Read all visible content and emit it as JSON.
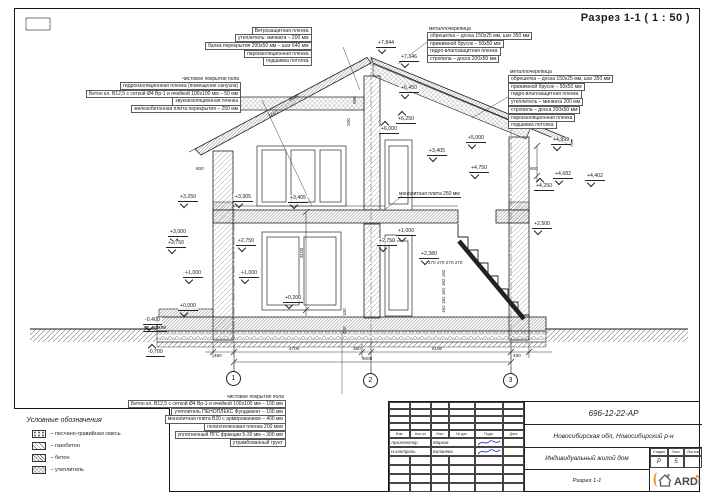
{
  "title": "Разрез 1-1 ( 1 : 50 )",
  "colors": {
    "accent": "#F7941E",
    "line": "#1c1c1c",
    "signature_blue": "#2a3ec9"
  },
  "annotation_blocks": [
    {
      "id": "ceiling-left",
      "x": 205,
      "y": 27,
      "align": "right",
      "title": "",
      "rows": [
        "Ветрозащитная пленка",
        "утеплитель: минвата – 200 мм",
        "балка перекрытия 200х50 мм – шаг 640 мм",
        "пароизоляционная пленка",
        "подшивка потолка"
      ]
    },
    {
      "id": "floor-2nd",
      "x": 86,
      "y": 76,
      "align": "right",
      "title": "чистовое покрытие пола",
      "rows": [
        "гидроизоляционная пленка (помещение санузла)",
        "Бетон кл. В12,5 с сеткой Ø4 Вр-1 и ячейкой 100х100 мм – 50 мм",
        "звукоизоляционная пленка",
        "железобетонная плита перекрытия – 250 мм"
      ]
    },
    {
      "id": "roof-cold",
      "x": 427,
      "y": 26,
      "align": "left",
      "title": "металлочерепица",
      "rows": [
        "обрешетка – доска 150х25 мм, шаг 350 мм",
        "прижимной брусок – 50х50 мм",
        "гидро-влагозащитная пленка",
        "стропила – доска 200х50 мм"
      ]
    },
    {
      "id": "roof-warm",
      "x": 508,
      "y": 69,
      "align": "left",
      "title": "металлочерепица",
      "rows": [
        "обрешетка – доска 150х25 мм, шаг 350 мм",
        "прижимной брусок – 50х50 мм",
        "гидро-влагозащитная пленка",
        "утеплитель – минвата 200 мм",
        "стропила – доска 200х50 мм",
        "пароизоляционная пленка",
        "подшивка потолка"
      ]
    },
    {
      "id": "floor-ground",
      "x": 128,
      "y": 394,
      "align": "right",
      "title": "чистовое покрытие пола",
      "rows": [
        "Бетон кл. В12,5 с сеткой Ø4 Вр-1 и ячейкой 100х100 мм – 100 мм",
        "утеплитель ПЕНОПЛЕКС Фундамент – 100 мм",
        "монолитная плита В20 с армированием – 400 мм",
        "полиэтиленовая пленка 200 мкм",
        "уплотненный ПГС фракции 5-20 мм – 300 мм",
        "утрамбованный грунт"
      ]
    }
  ],
  "labels": [
    {
      "t": "монолитная плита 250 мм",
      "x": 398,
      "y": 191,
      "u": true
    },
    {
      "t": "ур. земли",
      "x": 143,
      "y": 325,
      "u": true
    }
  ],
  "elevations": [
    {
      "v": "+7,844",
      "x": 376,
      "y": 40,
      "d": "down"
    },
    {
      "v": "+7,346",
      "x": 399,
      "y": 54,
      "d": "down"
    },
    {
      "v": "+6,450",
      "x": 399,
      "y": 85,
      "d": "down"
    },
    {
      "v": "+6,250",
      "x": 396,
      "y": 116,
      "d": "up"
    },
    {
      "v": "+6,000",
      "x": 379,
      "y": 126,
      "d": "up"
    },
    {
      "v": "+5,000",
      "x": 466,
      "y": 135,
      "d": "down"
    },
    {
      "v": "+4,999",
      "x": 551,
      "y": 137,
      "d": "down"
    },
    {
      "v": "+4,750",
      "x": 469,
      "y": 165,
      "d": "down"
    },
    {
      "v": "+4,682",
      "x": 553,
      "y": 171,
      "d": "down"
    },
    {
      "v": "+4,402",
      "x": 585,
      "y": 173,
      "d": "down"
    },
    {
      "v": "+4,250",
      "x": 534,
      "y": 183,
      "d": "up"
    },
    {
      "v": "+3,405",
      "x": 427,
      "y": 148,
      "d": "down"
    },
    {
      "v": "+3,250",
      "x": 178,
      "y": 194,
      "d": "down"
    },
    {
      "v": "+3,305",
      "x": 233,
      "y": 194,
      "d": "down"
    },
    {
      "v": "+3,405",
      "x": 288,
      "y": 195,
      "d": "down"
    },
    {
      "v": "+3,000",
      "x": 168,
      "y": 229,
      "d": "down"
    },
    {
      "v": "+2,750",
      "x": 166,
      "y": 240,
      "d": "down"
    },
    {
      "v": "+2,750",
      "x": 236,
      "y": 238,
      "d": "down"
    },
    {
      "v": "+2,750",
      "x": 377,
      "y": 238,
      "d": "down"
    },
    {
      "v": "+1,000",
      "x": 183,
      "y": 270,
      "d": "down"
    },
    {
      "v": "+1,000",
      "x": 239,
      "y": 270,
      "d": "down"
    },
    {
      "v": "+1,000",
      "x": 396,
      "y": 228,
      "d": "down"
    },
    {
      "v": "+2,500",
      "x": 532,
      "y": 221,
      "d": "down"
    },
    {
      "v": "+2,380",
      "x": 419,
      "y": 251,
      "d": "down"
    },
    {
      "v": "+0,200",
      "x": 283,
      "y": 295,
      "d": "down"
    },
    {
      "v": "+0,000",
      "x": 178,
      "y": 303,
      "d": "down"
    },
    {
      "v": "-0,400",
      "x": 143,
      "y": 317,
      "d": "down"
    },
    {
      "v": "-0,700",
      "x": 146,
      "y": 349,
      "d": "up"
    }
  ],
  "dims": [
    {
      "v": "600",
      "x": 196,
      "y": 166,
      "r": 0
    },
    {
      "v": "600",
      "x": 530,
      "y": 166,
      "r": 0
    },
    {
      "v": "996",
      "x": 352,
      "y": 104,
      "r": -90
    },
    {
      "v": "200",
      "x": 346,
      "y": 126,
      "r": -90
    },
    {
      "v": "3100",
      "x": 299,
      "y": 258,
      "r": -90
    },
    {
      "v": "5081",
      "x": 268,
      "y": 114,
      "r": -28
    },
    {
      "v": "4646",
      "x": 288,
      "y": 98,
      "r": -28
    },
    {
      "v": "270  270  270  270",
      "x": 428,
      "y": 260,
      "r": 0
    },
    {
      "v": "162 162 162 162 162",
      "x": 441,
      "y": 313,
      "r": -90
    },
    {
      "v": "400",
      "x": 342,
      "y": 334,
      "r": -90
    },
    {
      "v": "100",
      "x": 342,
      "y": 316,
      "r": -90
    },
    {
      "v": "480",
      "x": 214,
      "y": 353,
      "r": 0
    },
    {
      "v": "4700",
      "x": 289,
      "y": 346,
      "r": 0
    },
    {
      "v": "380",
      "x": 353,
      "y": 346,
      "r": 0
    },
    {
      "v": "6180",
      "x": 432,
      "y": 346,
      "r": 0
    },
    {
      "v": "480",
      "x": 513,
      "y": 353,
      "r": 0
    },
    {
      "v": "9000",
      "x": 362,
      "y": 356,
      "r": 0
    }
  ],
  "axes": [
    {
      "n": "1",
      "x": 226,
      "y": 371
    },
    {
      "n": "2",
      "x": 363,
      "y": 373
    },
    {
      "n": "3",
      "x": 503,
      "y": 373
    }
  ],
  "legend": {
    "title": "Условные обозначения",
    "items": [
      {
        "label": "–  песчано-гравийная смесь",
        "pattern": "pgs"
      },
      {
        "label": "–  газобетон",
        "pattern": "gas"
      },
      {
        "label": "–  бетон",
        "pattern": "concrete"
      },
      {
        "label": "–  утеплитель",
        "pattern": "insulation"
      }
    ]
  },
  "titleblock": {
    "doc_code": "696-12-22-АР",
    "location": "Новосибирская обл, Новосибирский р-н",
    "object": "Индивидуальный жилой дом",
    "sheet_name": "Разрез 1-1",
    "header_cols": [
      "Изм.",
      "Кол.уч",
      "Лист",
      "№ док.",
      "Подп.",
      "Дата"
    ],
    "people": [
      {
        "role": "Архитектор",
        "name": "Марков"
      },
      {
        "role": "Н.контроль",
        "name": "Баланева"
      }
    ],
    "stage_cols": [
      "Стадия",
      "Лист",
      "Листов"
    ],
    "stage": "Р",
    "sheet_no": "5",
    "sheets_total": "",
    "logo_text": "ARDi"
  }
}
